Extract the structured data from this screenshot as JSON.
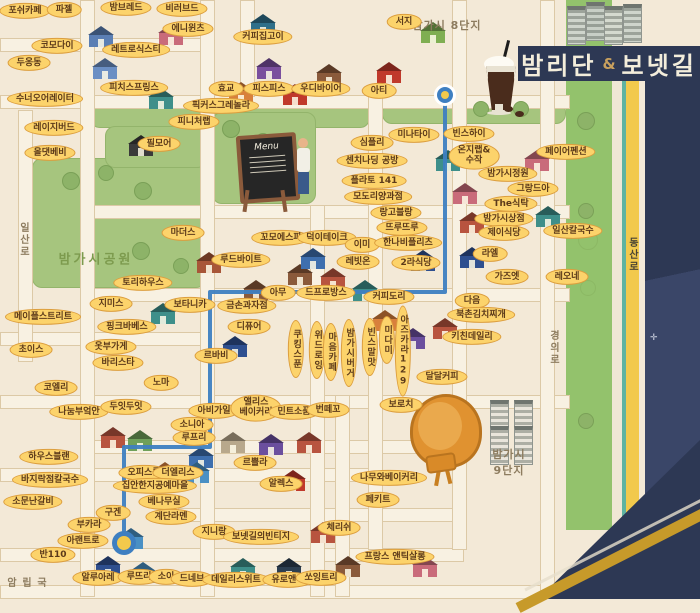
{
  "title": {
    "main": "밤리단",
    "amp": "&",
    "sub": "보넷길"
  },
  "area_texts": [
    {
      "text": "밤가시 8단지",
      "x": 447,
      "y": 25,
      "cls": ""
    },
    {
      "text": "밤가시공원",
      "x": 96,
      "y": 258,
      "cls": "park-t"
    },
    {
      "text": "밤가시\n9단지",
      "x": 509,
      "y": 462,
      "cls": ""
    },
    {
      "text": "일산로",
      "x": 23,
      "y": 240,
      "cls": "vert"
    },
    {
      "text": "동산로",
      "x": 632,
      "y": 255,
      "cls": "vert on-yellow"
    },
    {
      "text": "경의로",
      "x": 553,
      "y": 348,
      "cls": "vert"
    },
    {
      "text": "국립암",
      "x": 25,
      "y": 583,
      "cls": "vert"
    }
  ],
  "labels": [
    {
      "text": "포쉬카페",
      "x": 25,
      "y": 11
    },
    {
      "text": "파젤",
      "x": 64,
      "y": 10
    },
    {
      "text": "밤브레드",
      "x": 126,
      "y": 8
    },
    {
      "text": "비러브드",
      "x": 182,
      "y": 9
    },
    {
      "text": "에니윈츠",
      "x": 188,
      "y": 29
    },
    {
      "text": "코모다이",
      "x": 57,
      "y": 46
    },
    {
      "text": "레트로식스티",
      "x": 136,
      "y": 50
    },
    {
      "text": "두옹동",
      "x": 29,
      "y": 63
    },
    {
      "text": "커피집고이",
      "x": 263,
      "y": 37
    },
    {
      "text": "피치스프링스",
      "x": 134,
      "y": 88
    },
    {
      "text": "수너오어레이터",
      "x": 45,
      "y": 99
    },
    {
      "text": "픽커스그레놀라",
      "x": 221,
      "y": 106
    },
    {
      "text": "효교",
      "x": 226,
      "y": 89
    },
    {
      "text": "피스피스",
      "x": 269,
      "y": 89
    },
    {
      "text": "우디바이어",
      "x": 321,
      "y": 89
    },
    {
      "text": "아티",
      "x": 379,
      "y": 91
    },
    {
      "text": "서지",
      "x": 404,
      "y": 22
    },
    {
      "text": "레이지버드",
      "x": 54,
      "y": 128
    },
    {
      "text": "올댓베비",
      "x": 50,
      "y": 153
    },
    {
      "text": "필모어",
      "x": 159,
      "y": 144
    },
    {
      "text": "피니처랩",
      "x": 194,
      "y": 122
    },
    {
      "text": "미나타이",
      "x": 414,
      "y": 135
    },
    {
      "text": "빈스하이",
      "x": 469,
      "y": 134
    },
    {
      "text": "심플리",
      "x": 372,
      "y": 143
    },
    {
      "text": "센치나딩 공방",
      "x": 372,
      "y": 161
    },
    {
      "text": "온지랩&\n수작",
      "x": 474,
      "y": 156
    },
    {
      "text": "페이어펜션",
      "x": 566,
      "y": 152
    },
    {
      "text": "플라토 141",
      "x": 374,
      "y": 181
    },
    {
      "text": "모도리양과점",
      "x": 378,
      "y": 197
    },
    {
      "text": "랑고블랑",
      "x": 396,
      "y": 213
    },
    {
      "text": "뜨루뜨루",
      "x": 402,
      "y": 228
    },
    {
      "text": "밤가시정원",
      "x": 508,
      "y": 174
    },
    {
      "text": "그랑드아",
      "x": 533,
      "y": 189
    },
    {
      "text": "The식탁",
      "x": 511,
      "y": 204
    },
    {
      "text": "밤가시상점",
      "x": 504,
      "y": 219
    },
    {
      "text": "제이식당",
      "x": 504,
      "y": 233
    },
    {
      "text": "일산칼국수",
      "x": 573,
      "y": 231
    },
    {
      "text": "마더스",
      "x": 183,
      "y": 233
    },
    {
      "text": "꼬모에스파",
      "x": 281,
      "y": 238
    },
    {
      "text": "덕이테이크",
      "x": 327,
      "y": 238
    },
    {
      "text": "이미",
      "x": 362,
      "y": 245
    },
    {
      "text": "루드바이트",
      "x": 241,
      "y": 260
    },
    {
      "text": "레빗온",
      "x": 358,
      "y": 262
    },
    {
      "text": "한나비플리츠",
      "x": 408,
      "y": 243
    },
    {
      "text": "2라식당",
      "x": 416,
      "y": 263
    },
    {
      "text": "라엘",
      "x": 490,
      "y": 254
    },
    {
      "text": "가즈엣",
      "x": 507,
      "y": 277
    },
    {
      "text": "레오네",
      "x": 567,
      "y": 277
    },
    {
      "text": "토리하우스",
      "x": 143,
      "y": 283
    },
    {
      "text": "지미스",
      "x": 111,
      "y": 304
    },
    {
      "text": "보타니카",
      "x": 190,
      "y": 305
    },
    {
      "text": "메이플스트리트",
      "x": 43,
      "y": 317
    },
    {
      "text": "핑크바베스",
      "x": 127,
      "y": 327
    },
    {
      "text": "금손과자점",
      "x": 247,
      "y": 306
    },
    {
      "text": "아무",
      "x": 278,
      "y": 293
    },
    {
      "text": "드프로방스",
      "x": 326,
      "y": 293
    },
    {
      "text": "커피도리",
      "x": 389,
      "y": 297
    },
    {
      "text": "다음",
      "x": 472,
      "y": 301
    },
    {
      "text": "북촌김치찌개",
      "x": 481,
      "y": 315
    },
    {
      "text": "키친데일리",
      "x": 472,
      "y": 337
    },
    {
      "text": "디퓨어",
      "x": 249,
      "y": 327
    },
    {
      "text": "초이스",
      "x": 31,
      "y": 350
    },
    {
      "text": "옷부가게",
      "x": 111,
      "y": 347
    },
    {
      "text": "바리스타",
      "x": 118,
      "y": 363
    },
    {
      "text": "르바비",
      "x": 216,
      "y": 356
    },
    {
      "text": "코엘리",
      "x": 56,
      "y": 388
    },
    {
      "text": "노마",
      "x": 161,
      "y": 383
    },
    {
      "text": "나눔부엌안",
      "x": 79,
      "y": 412
    },
    {
      "text": "두잇두잇",
      "x": 126,
      "y": 407
    },
    {
      "text": "소니아",
      "x": 192,
      "y": 425
    },
    {
      "text": "루프리",
      "x": 194,
      "y": 438
    },
    {
      "text": "쿠킹스푼",
      "x": 296,
      "y": 349,
      "v": true
    },
    {
      "text": "위드로잉",
      "x": 317,
      "y": 350,
      "v": true
    },
    {
      "text": "마음카페",
      "x": 331,
      "y": 352,
      "v": true
    },
    {
      "text": "밤가시버거",
      "x": 349,
      "y": 353,
      "v": true
    },
    {
      "text": "빈스말맛",
      "x": 370,
      "y": 347,
      "v": true
    },
    {
      "text": "미다미",
      "x": 387,
      "y": 340,
      "v": true
    },
    {
      "text": "아즈카라129",
      "x": 403,
      "y": 351,
      "v": true
    },
    {
      "text": "달달커피",
      "x": 442,
      "y": 377
    },
    {
      "text": "보로치",
      "x": 401,
      "y": 405
    },
    {
      "text": "아비가일",
      "x": 214,
      "y": 411
    },
    {
      "text": "앨리스\n베이커리",
      "x": 256,
      "y": 408
    },
    {
      "text": "민트소품",
      "x": 294,
      "y": 412
    },
    {
      "text": "번떼꼬",
      "x": 328,
      "y": 410
    },
    {
      "text": "르쁠라",
      "x": 255,
      "y": 463
    },
    {
      "text": "하우스블랜",
      "x": 49,
      "y": 457
    },
    {
      "text": "오피스룸",
      "x": 144,
      "y": 473
    },
    {
      "text": "더엘리스",
      "x": 178,
      "y": 473
    },
    {
      "text": "집안한지공예마을",
      "x": 155,
      "y": 486
    },
    {
      "text": "바지락점칼국수",
      "x": 50,
      "y": 480
    },
    {
      "text": "소문난갈비",
      "x": 33,
      "y": 502
    },
    {
      "text": "구겐",
      "x": 113,
      "y": 513
    },
    {
      "text": "베나무실",
      "x": 164,
      "y": 502
    },
    {
      "text": "계단라멘",
      "x": 171,
      "y": 517
    },
    {
      "text": "부카라",
      "x": 89,
      "y": 525
    },
    {
      "text": "아랜트로",
      "x": 83,
      "y": 541
    },
    {
      "text": "반110",
      "x": 53,
      "y": 555
    },
    {
      "text": "알루아레",
      "x": 98,
      "y": 578
    },
    {
      "text": "루뜨리",
      "x": 139,
      "y": 577
    },
    {
      "text": "소이",
      "x": 166,
      "y": 577
    },
    {
      "text": "드네브",
      "x": 192,
      "y": 579
    },
    {
      "text": "데일리스위트",
      "x": 236,
      "y": 580
    },
    {
      "text": "유로앤틱",
      "x": 288,
      "y": 580
    },
    {
      "text": "쏘잉트리",
      "x": 321,
      "y": 578
    },
    {
      "text": "알렉스",
      "x": 281,
      "y": 484
    },
    {
      "text": "지니랑",
      "x": 214,
      "y": 532
    },
    {
      "text": "보넷길의빈티지",
      "x": 261,
      "y": 537
    },
    {
      "text": "체리쉬",
      "x": 339,
      "y": 528
    },
    {
      "text": "프랑스 앤틱살롱",
      "x": 395,
      "y": 557
    },
    {
      "text": "나무와베이커리",
      "x": 389,
      "y": 478
    },
    {
      "text": "페키트",
      "x": 378,
      "y": 500
    }
  ],
  "route": {
    "color": "#3e7fc1",
    "points": [
      [
        445,
        95
      ],
      [
        445,
        292
      ],
      [
        210,
        292
      ],
      [
        210,
        447
      ],
      [
        124,
        447
      ],
      [
        124,
        543
      ]
    ],
    "start": {
      "x": 445,
      "y": 95
    },
    "end": {
      "x": 124,
      "y": 543
    }
  },
  "illustration": {
    "menu_text": "Menu"
  },
  "roads": {
    "h": [
      [
        38,
        0,
        205
      ],
      [
        95,
        0,
        568
      ],
      [
        205,
        85,
        568
      ],
      [
        288,
        85,
        568
      ],
      [
        332,
        0,
        212
      ],
      [
        395,
        0,
        568
      ],
      [
        440,
        85,
        462
      ],
      [
        468,
        0,
        368
      ],
      [
        508,
        178,
        462
      ],
      [
        548,
        0,
        462
      ],
      [
        585,
        0,
        540
      ]
    ],
    "v": [
      [
        80,
        0,
        595
      ],
      [
        200,
        0,
        595
      ],
      [
        310,
        205,
        595
      ],
      [
        240,
        0,
        95
      ],
      [
        368,
        95,
        548
      ],
      [
        452,
        0,
        548
      ],
      [
        540,
        0,
        595
      ],
      [
        335,
        395,
        595
      ],
      [
        18,
        110,
        360
      ]
    ]
  },
  "parks": [
    [
      90,
      100,
      278,
      26
    ],
    [
      382,
      102,
      182,
      20
    ],
    [
      32,
      158,
      172,
      128
    ],
    [
      212,
      112,
      102,
      90
    ],
    [
      105,
      126,
      100,
      40
    ]
  ],
  "buildings": [
    {
      "x": 88,
      "y": 26,
      "c": "#5b7fb4"
    },
    {
      "x": 92,
      "y": 58,
      "c": "#6b8fc4"
    },
    {
      "x": 158,
      "y": 24,
      "c": "#c96b7a"
    },
    {
      "x": 148,
      "y": 88,
      "c": "#3e8f8a"
    },
    {
      "x": 250,
      "y": 14,
      "c": "#2e6f8a"
    },
    {
      "x": 256,
      "y": 58,
      "c": "#7a4f9e"
    },
    {
      "x": 282,
      "y": 84,
      "c": "#c0392b"
    },
    {
      "x": 228,
      "y": 82,
      "c": "#d8803c"
    },
    {
      "x": 316,
      "y": 64,
      "c": "#8a5a3b"
    },
    {
      "x": 376,
      "y": 62,
      "c": "#c0392b"
    },
    {
      "x": 420,
      "y": 22,
      "c": "#7fae52"
    },
    {
      "x": 128,
      "y": 135,
      "c": "#3a3a3a"
    },
    {
      "x": 435,
      "y": 150,
      "c": "#3e8f8a"
    },
    {
      "x": 452,
      "y": 183,
      "c": "#c96b7a"
    },
    {
      "x": 459,
      "y": 212,
      "c": "#b8543f"
    },
    {
      "x": 524,
      "y": 150,
      "c": "#c96b7a"
    },
    {
      "x": 535,
      "y": 206,
      "c": "#3e8f8a"
    },
    {
      "x": 459,
      "y": 247,
      "c": "#2e4f8f"
    },
    {
      "x": 196,
      "y": 252,
      "c": "#a85638"
    },
    {
      "x": 243,
      "y": 280,
      "c": "#8a5a3b"
    },
    {
      "x": 287,
      "y": 264,
      "c": "#8a5a3b"
    },
    {
      "x": 320,
      "y": 268,
      "c": "#b8543f"
    },
    {
      "x": 352,
      "y": 280,
      "c": "#3e8f8a"
    },
    {
      "x": 300,
      "y": 248,
      "c": "#3e6fae"
    },
    {
      "x": 410,
      "y": 250,
      "c": "#2e4f8f"
    },
    {
      "x": 150,
      "y": 303,
      "c": "#3e8f8a"
    },
    {
      "x": 222,
      "y": 336,
      "c": "#2e4f8f"
    },
    {
      "x": 372,
      "y": 310,
      "c": "#d8803c"
    },
    {
      "x": 400,
      "y": 328,
      "c": "#6b4f9e"
    },
    {
      "x": 432,
      "y": 318,
      "c": "#b8543f"
    },
    {
      "x": 100,
      "y": 427,
      "c": "#b8543f"
    },
    {
      "x": 127,
      "y": 430,
      "c": "#6fa05a"
    },
    {
      "x": 188,
      "y": 447,
      "c": "#3e6fae"
    },
    {
      "x": 220,
      "y": 432,
      "c": "#b8a88c"
    },
    {
      "x": 258,
      "y": 434,
      "c": "#6b4f9e"
    },
    {
      "x": 296,
      "y": 432,
      "c": "#b8543f"
    },
    {
      "x": 152,
      "y": 462,
      "c": "#d8803c"
    },
    {
      "x": 184,
      "y": 462,
      "c": "#4a90c4"
    },
    {
      "x": 280,
      "y": 470,
      "c": "#c0392b"
    },
    {
      "x": 310,
      "y": 522,
      "c": "#b8543f"
    },
    {
      "x": 118,
      "y": 528,
      "c": "#4a90c4"
    },
    {
      "x": 95,
      "y": 556,
      "c": "#2e4f8f"
    },
    {
      "x": 130,
      "y": 562,
      "c": "#4a90c4"
    },
    {
      "x": 230,
      "y": 558,
      "c": "#3e8f8a"
    },
    {
      "x": 276,
      "y": 558,
      "c": "#2c3e50"
    },
    {
      "x": 335,
      "y": 556,
      "c": "#8a5a3b"
    },
    {
      "x": 412,
      "y": 556,
      "c": "#c96b7a"
    },
    {
      "x": 567,
      "y": 6,
      "c": "#cfd5cc",
      "a": 1
    },
    {
      "x": 586,
      "y": 2,
      "c": "#c8cfc6",
      "a": 1
    },
    {
      "x": 604,
      "y": 6,
      "c": "#d5dacf",
      "a": 1
    },
    {
      "x": 623,
      "y": 4,
      "c": "#cfd5cc",
      "a": 1
    },
    {
      "x": 490,
      "y": 400,
      "c": "#e9e5db",
      "a": 1
    },
    {
      "x": 514,
      "y": 400,
      "c": "#e9e5db",
      "a": 1
    },
    {
      "x": 490,
      "y": 426,
      "c": "#e9e5db",
      "a": 1
    },
    {
      "x": 514,
      "y": 426,
      "c": "#e9e5db",
      "a": 1
    }
  ],
  "trees": [
    {
      "x": 70,
      "y": 180,
      "r": 8
    },
    {
      "x": 105,
      "y": 172,
      "r": 7
    },
    {
      "x": 142,
      "y": 190,
      "r": 8
    },
    {
      "x": 230,
      "y": 128,
      "r": 8
    },
    {
      "x": 262,
      "y": 140,
      "r": 7
    },
    {
      "x": 180,
      "y": 265,
      "r": 7
    },
    {
      "x": 140,
      "y": 250,
      "r": 8
    },
    {
      "x": 480,
      "y": 108,
      "r": 7
    },
    {
      "x": 520,
      "y": 108,
      "r": 7
    },
    {
      "x": 585,
      "y": 120,
      "r": 8
    },
    {
      "x": 585,
      "y": 210,
      "r": 7
    },
    {
      "x": 585,
      "y": 420,
      "r": 7
    }
  ],
  "beans": [
    {
      "x": 504,
      "y": 106
    },
    {
      "x": 515,
      "y": 111
    }
  ]
}
